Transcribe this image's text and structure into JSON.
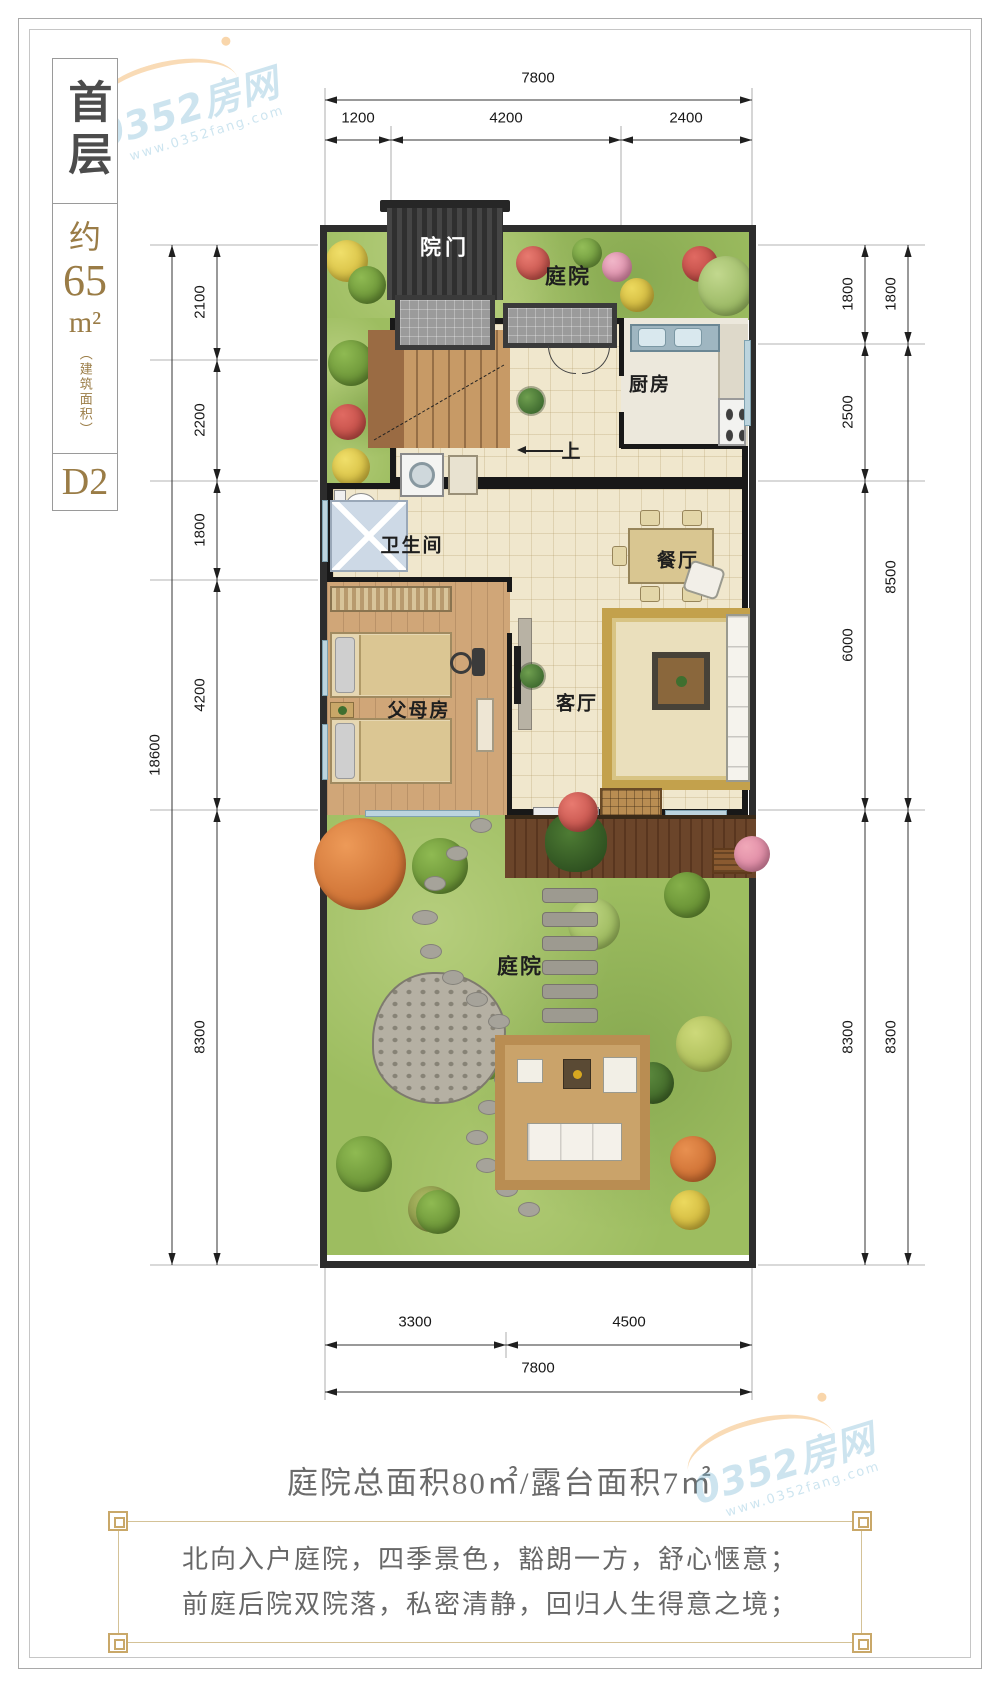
{
  "sidebar": {
    "floor": "首层",
    "area_prefix": "约",
    "area_value": "65",
    "area_unit": "m²",
    "area_note": "（建筑面积）",
    "unit_code": "D2"
  },
  "dimensions": {
    "top": {
      "total": "7800",
      "segments": [
        "1200",
        "4200",
        "2400"
      ]
    },
    "bottom": {
      "total": "7800",
      "segments": [
        "3300",
        "4500"
      ]
    },
    "left": {
      "total": "18600",
      "segments": [
        "2100",
        "2200",
        "1800",
        "4200",
        "8300"
      ]
    },
    "right_inner": [
      "1800",
      "2500",
      "6000",
      "8300"
    ],
    "right_outer": [
      "1800",
      "8500",
      "8300"
    ]
  },
  "plan": {
    "labels": {
      "gate": "院门",
      "front_yard": "庭院",
      "kitchen": "厨房",
      "stairs_up": "上",
      "bathroom": "卫生间",
      "dining": "餐厅",
      "parents_room": "父母房",
      "living": "客厅",
      "back_yard": "庭院"
    }
  },
  "footer": {
    "area_summary": "庭院总面积80㎡/露台面积7㎡",
    "lines": [
      "北向入户庭院，四季景色，豁朗一方，舒心惬意；",
      "前庭后院双院落，私密清静，回归人生得意之境；"
    ]
  },
  "watermark": {
    "brand": "0352房网",
    "url": "www.0352fang.com"
  },
  "colors": {
    "accent_gold": "#9a7c46",
    "wall": "#181818",
    "garden_green": "#9dbd60",
    "dim_line": "#333333"
  }
}
